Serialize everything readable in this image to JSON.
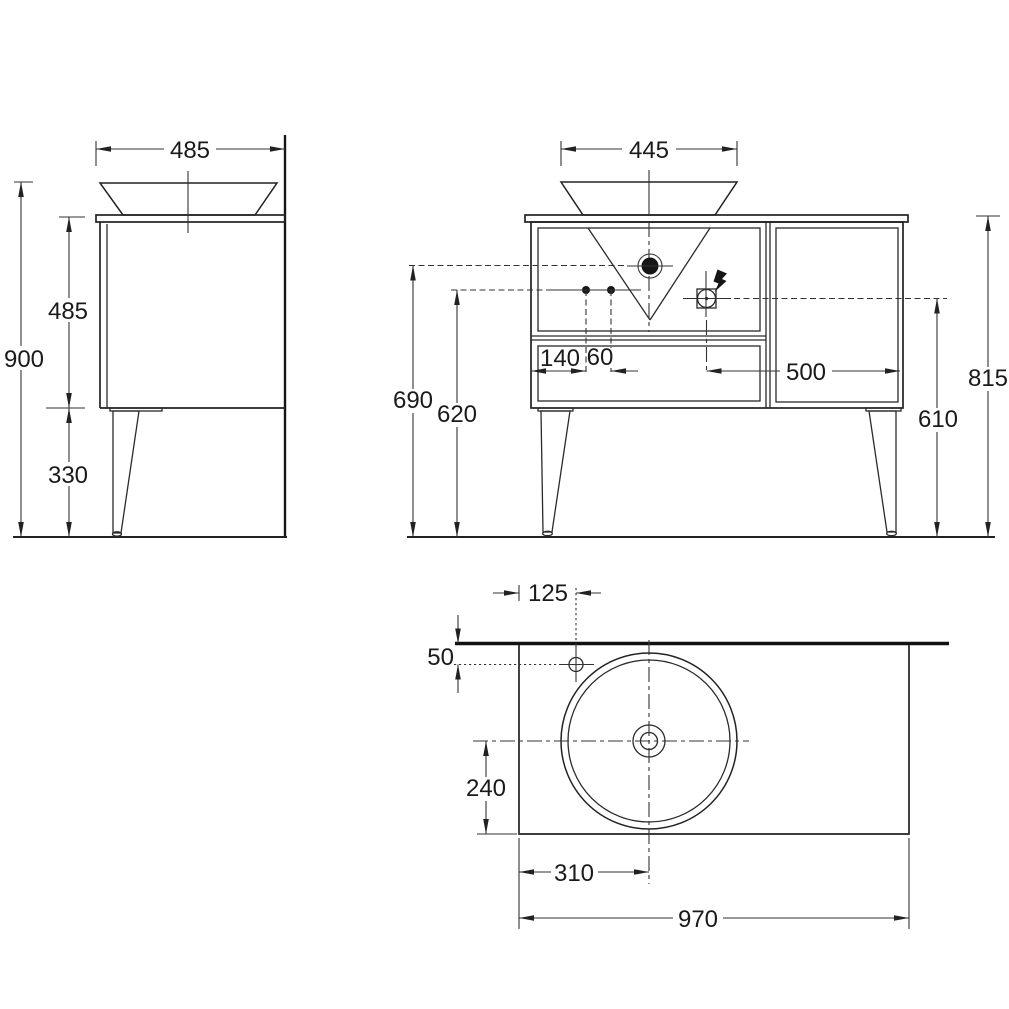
{
  "drawing": {
    "background": "#ffffff",
    "line_color": "#222222"
  },
  "views": {
    "side": {
      "dims": {
        "top_depth": "485",
        "overall_height": "900",
        "cabinet_height": "485",
        "leg_height": "330"
      }
    },
    "front": {
      "dims": {
        "basin_diameter": "445",
        "hole_offset": "140",
        "hole_spacing": "60",
        "outlet_offset": "500",
        "drain_height": "690",
        "holes_height": "620",
        "outlet_height": "610",
        "worktop_height": "815"
      }
    },
    "plan": {
      "dims": {
        "tap_from_left": "125",
        "tap_from_wall": "50",
        "basin_center_from_front": "240",
        "basin_center_from_left": "310",
        "overall_width": "970"
      }
    }
  }
}
